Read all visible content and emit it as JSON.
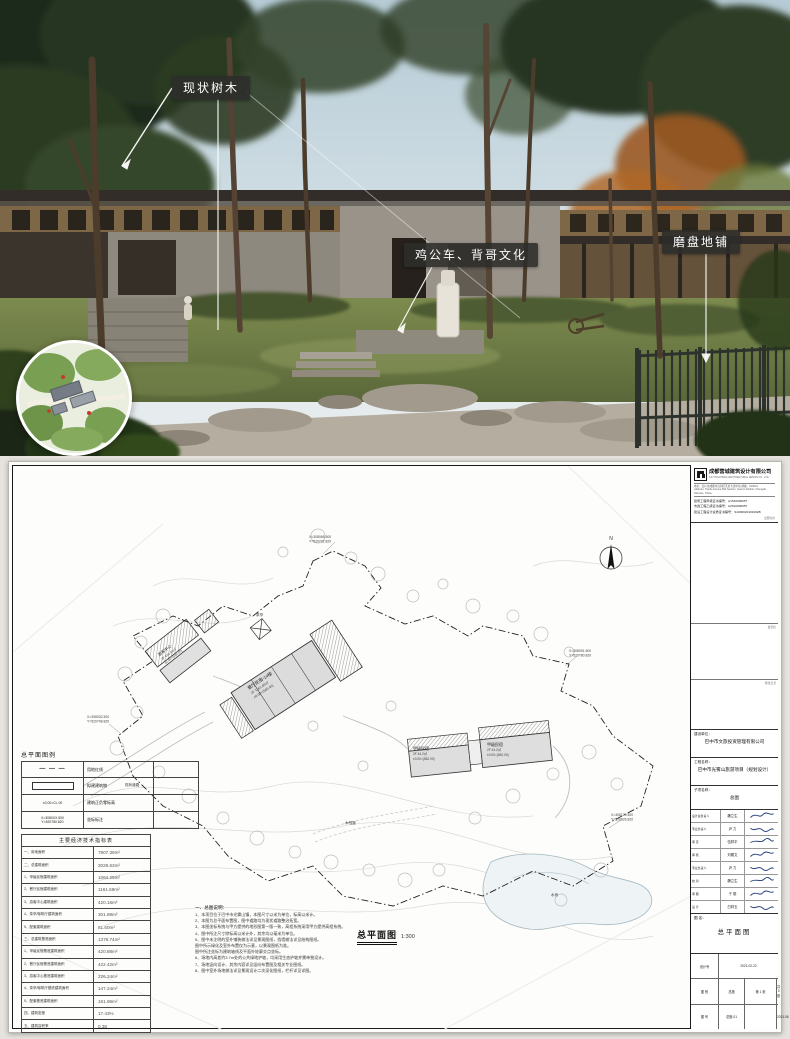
{
  "render": {
    "callouts": [
      {
        "text": "现状树木"
      },
      {
        "text": "鸡公车、背哥文化"
      },
      {
        "text": "磨盘地铺"
      }
    ]
  },
  "sheet": {
    "company": {
      "name": "成都营城建筑设计有限公司",
      "name_en": "CD YINGCHENG ARCHITECTURAL DESIGN CO., LTD.",
      "address1": "地址：四川省成都市高新区天府大道中段 邮编：610041",
      "address2": "Address: Tianfu Avenue Mid Section, Gaoxin District, Chengdu, Sichuan, China",
      "certs": [
        "建筑工程甲级证书编号：A1510000057",
        "市政工程乙级证书编号：A2510000057",
        "建设工程设计资质证书编号：S1000020101002B"
      ],
      "seal": "出图专用"
    },
    "sections": {
      "sign_bar": "会签栏",
      "revision_bar": "修改记录"
    },
    "owner_label": "建设单位：",
    "owner": "巴中市文旅投资管理有限公司",
    "project_label": "工程名称：",
    "project": "巴中市光雾山旅游项目（规划设计）",
    "subitem_label": "子项名称：",
    "subitem": "总图",
    "signatures": [
      {
        "role": "设计总负责人",
        "name": "魏立生"
      },
      {
        "role": "专业负责人",
        "name": "尹 力"
      },
      {
        "role": "审 定",
        "name": "伍祥平"
      },
      {
        "role": "审 核",
        "name": "刘耀文"
      },
      {
        "role": "专业负责人",
        "name": "尹 力"
      },
      {
        "role": "校 对",
        "name": "魏立生"
      },
      {
        "role": "审 图",
        "name": "于 丽"
      },
      {
        "role": "设 计",
        "name": "白祥玉"
      }
    ],
    "drawing_name_label": "图 名：",
    "drawing_name": "总平面图",
    "grid": {
      "design_no_label": "设计号",
      "date": "2021-02-22",
      "category_label": "图 别",
      "category": "总施",
      "sheet_no": "第 1 张",
      "no_label": "图 号",
      "no": "总施-01",
      "total": "共 3 张",
      "issue": "2021.06"
    }
  },
  "legend": {
    "title": "总平面图例",
    "rows": [
      {
        "type": "dash",
        "symbol": "",
        "label": "用地红线"
      },
      {
        "type": "rect",
        "symbol": "",
        "label": "拟建建筑物"
      },
      {
        "type": "text",
        "symbol": "±0.00=CL.00",
        "label": "建筑正负零标高"
      },
      {
        "type": "text2",
        "symbol": "X=3080XX.500",
        "symbol2": "Y=520780.820",
        "label": "坐标标注"
      }
    ]
  },
  "indicators": {
    "title": "主要经济技术指标表",
    "rows": [
      {
        "label": "一、用地面积",
        "value": "7907.39m²"
      },
      {
        "label": "二、总建筑面积",
        "value": "3029.63m²"
      },
      {
        "label": "1、甲级民宿建筑面积",
        "value": "1064.29m²"
      },
      {
        "label": "2、餐厅民宿建筑面积",
        "value": "1161.69m²"
      },
      {
        "label": "3、游客中心建筑面积",
        "value": "420.16m²"
      },
      {
        "label": "4、茶亭/咖啡厅建筑面积",
        "value": "301.89m²"
      },
      {
        "label": "5、配套建筑面积",
        "value": "81.60m²"
      },
      {
        "label": "三、总建筑基底面积",
        "value": "1378.74m²"
      },
      {
        "label": "1、甲级民宿基底建筑面积",
        "value": "420.88m²"
      },
      {
        "label": "2、餐厅民宿基底建筑面积",
        "value": "422.42m²"
      },
      {
        "label": "3、游客中心基底建筑面积",
        "value": "226.24m²"
      },
      {
        "label": "4、茶亭/咖啡厅基底建筑面积",
        "value": "147.24m²"
      },
      {
        "label": "5、配套基底建筑面积",
        "value": "161.96m²"
      },
      {
        "label": "四、建筑密度",
        "value": "17.43%"
      },
      {
        "label": "五、建筑容积率",
        "value": "0.38"
      }
    ]
  },
  "notes": {
    "title": "一、总图说明：",
    "items": [
      "1、本项目位于巴中市光雾山镇，本图尺寸以米为单位，标高以米计。",
      "2、本图为总平面布置图，图中道路均为现状道路整治拓宽。",
      "3、本图坐标系统与甲方提供的地形图第一版一致，高程系统采用甲方提供高程系统。",
      "4、图中所注尺寸除标高以米计外，其余均以毫米为单位。",
      "5、图中未注明的室外铺装做法详见景观图纸，挡墙做法详见结构图纸。",
      "图中所示绿化及室外布置仅为示意，以景观图纸为准。",
      "图中所注坐标为建筑轴线及平面外轮廓交点坐标。",
      "6、场地内高差约3.7m处的公共绿地护坡，均采用生态护坡并需单独设计。",
      "7、场地竖向设计、其余内容详见竖向布置图及相关专业图纸。",
      "8、图中室外场地做法详见景观设计二次深化图纸，栏杆详见详图。"
    ]
  },
  "plan": {
    "title": "总平面图",
    "scale": "1:300",
    "north": "N",
    "coords": [
      {
        "x": "X=308065.500",
        "y": "Y=520702.820"
      },
      {
        "x": "X=308091.500",
        "y": "Y=520780.820"
      },
      {
        "x": "X=308032.500",
        "y": "Y=520748.820"
      },
      {
        "x": "X=308120.500",
        "y": "Y=520826.820"
      }
    ],
    "buildings": [
      {
        "name": "餐厅民宿-1#楼",
        "area": "2F 1161.69㎡",
        "elev": "±0.00=(565.40)"
      },
      {
        "name": "甲级民宿",
        "area": "2F 44.2㎡",
        "elev": "±0.00=(562.00)"
      },
      {
        "name": "甲级民宿",
        "area": "2F 44.2㎡",
        "elev": "±0.00=(562.00)"
      },
      {
        "name": "游客中心",
        "area": "2F 420.16㎡",
        "elev": "±0.00=(560.00)"
      }
    ],
    "features": [
      "茶亭",
      "木栈道",
      "水系",
      "现状道路"
    ]
  }
}
